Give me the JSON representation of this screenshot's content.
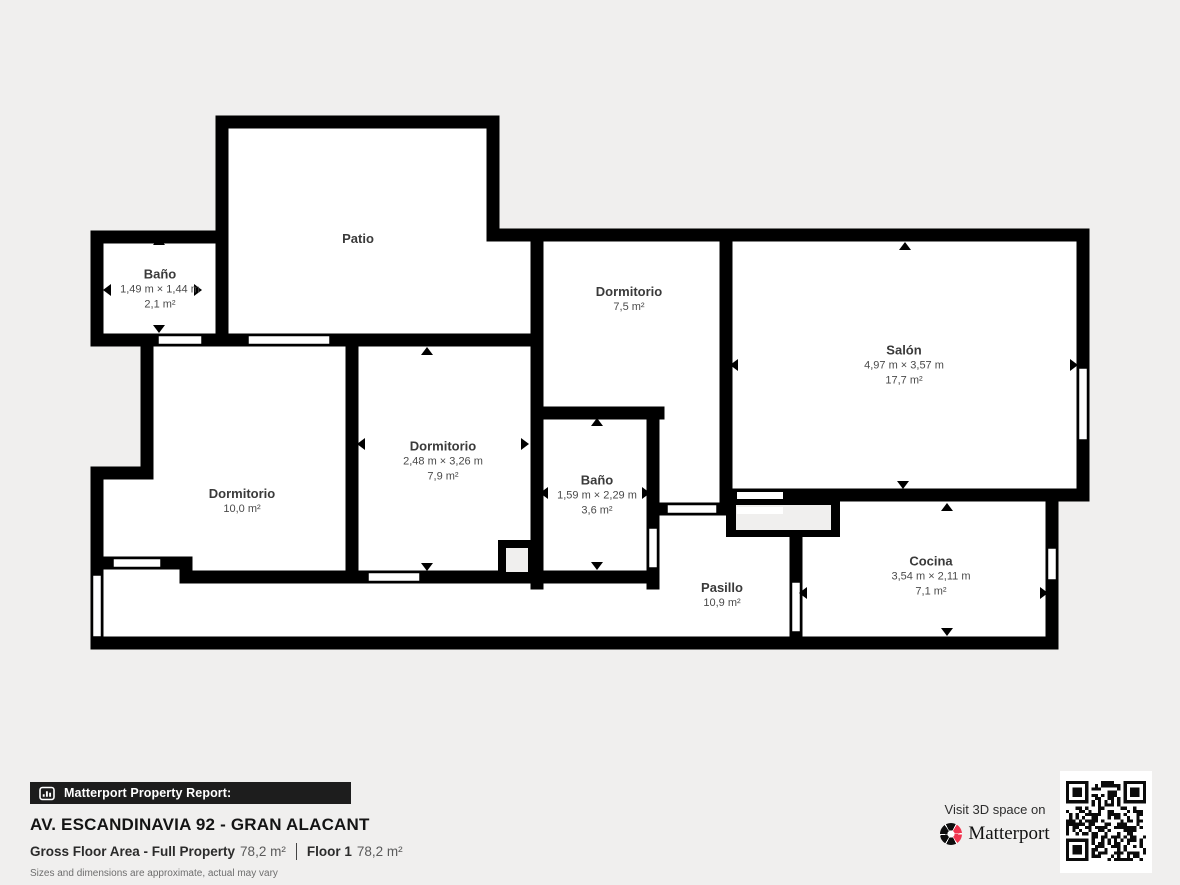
{
  "colors": {
    "background": "#f0efee",
    "walls": "#000000",
    "room_fill": "#ffffff",
    "brand_red": "#f0344e",
    "bar_background": "#1d1d1d"
  },
  "rooms": [
    {
      "name": "Patio",
      "dims": "",
      "area": ""
    },
    {
      "name": "Baño",
      "dims": "1,49 m × 1,44 m",
      "area": "2,1 m²"
    },
    {
      "name": "Dormitorio",
      "dims": "",
      "area": "7,5 m²"
    },
    {
      "name": "Salón",
      "dims": "4,97 m × 3,57 m",
      "area": "17,7 m²"
    },
    {
      "name": "Dormitorio",
      "dims": "2,48 m × 3,26 m",
      "area": "7,9 m²"
    },
    {
      "name": "Dormitorio",
      "dims": "",
      "area": "10,0 m²"
    },
    {
      "name": "Baño",
      "dims": "1,59 m × 2,29 m",
      "area": "3,6 m²"
    },
    {
      "name": "Pasillo",
      "dims": "",
      "area": "10,9 m²"
    },
    {
      "name": "Cocina",
      "dims": "3,54 m × 2,11 m",
      "area": "7,1 m²"
    }
  ],
  "footer": {
    "report_label": "Matterport Property Report:",
    "address": "AV. ESCANDINAVIA 92 - GRAN ALACANT",
    "gross_label": "Gross Floor Area - Full Property",
    "gross_value": "78,2 m²",
    "floor_label": "Floor 1",
    "floor_value": "78,2 m²",
    "disclaimer": "Sizes and dimensions are approximate, actual may vary",
    "visit_label": "Visit 3D space on",
    "brand": "Matterport"
  }
}
